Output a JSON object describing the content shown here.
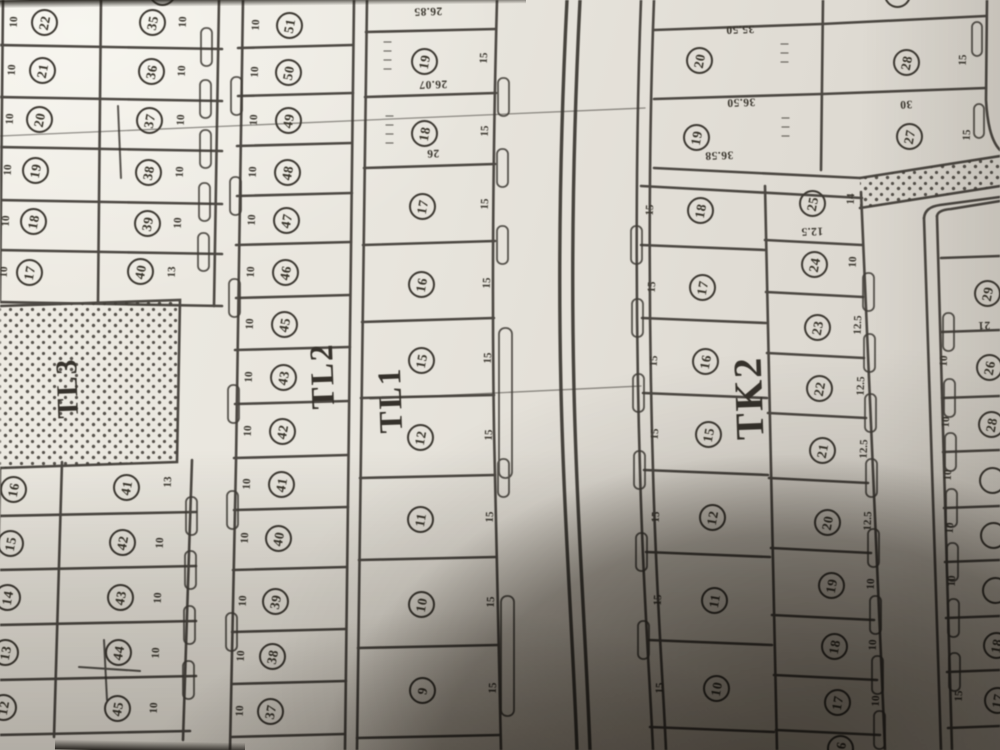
{
  "colors": {
    "paper": "#e7e4dc",
    "ink": "#3a362f",
    "shadow": "#2a251d",
    "line": "#3d3933"
  },
  "blocks": [
    {
      "label": "TL3",
      "x": 68,
      "y": 388,
      "size": 30
    },
    {
      "label": "TL2",
      "x": 323,
      "y": 376,
      "size": 33
    },
    {
      "label": "TL1",
      "x": 391,
      "y": 400,
      "size": 33
    },
    {
      "label": "TK2",
      "x": 749,
      "y": 398,
      "size": 40
    }
  ],
  "plot_groups": [
    {
      "name": "left-column-upper",
      "plots": [
        {
          "n": "22",
          "x": 44,
          "y": 22,
          "edge": "10",
          "ex": 14,
          "ey": 24
        },
        {
          "n": "21",
          "x": 42,
          "y": 70,
          "edge": "10",
          "ex": 12,
          "ey": 72
        },
        {
          "n": "20",
          "x": 39,
          "y": 119,
          "edge": "10",
          "ex": 10,
          "ey": 121
        },
        {
          "n": "19",
          "x": 35,
          "y": 170,
          "edge": "10",
          "ex": 8,
          "ey": 172
        },
        {
          "n": "18",
          "x": 33,
          "y": 221,
          "edge": "10",
          "ex": 6,
          "ey": 223
        },
        {
          "n": "17",
          "x": 29,
          "y": 272,
          "edge": "10",
          "ex": 4,
          "ey": 274
        }
      ]
    },
    {
      "name": "left-column-lower",
      "plots": [
        {
          "n": "16",
          "x": 13,
          "y": 489
        },
        {
          "n": "15",
          "x": 10,
          "y": 543
        },
        {
          "n": "14",
          "x": 7,
          "y": 597
        },
        {
          "n": "13",
          "x": 5,
          "y": 652
        },
        {
          "n": "12",
          "x": 3,
          "y": 707
        }
      ]
    },
    {
      "name": "second-column-upper",
      "plots": [
        {
          "n": "35",
          "x": 152,
          "y": 22,
          "edge": "10",
          "ex": 183,
          "ey": 24
        },
        {
          "n": "36",
          "x": 151,
          "y": 71,
          "edge": "10",
          "ex": 182,
          "ey": 73
        },
        {
          "n": "37",
          "x": 149,
          "y": 120,
          "edge": "10",
          "ex": 181,
          "ey": 122
        },
        {
          "n": "38",
          "x": 148,
          "y": 172,
          "edge": "10",
          "ex": 180,
          "ey": 174
        },
        {
          "n": "39",
          "x": 147,
          "y": 223,
          "edge": "10",
          "ex": 178,
          "ey": 225
        },
        {
          "n": "40",
          "x": 140,
          "y": 271,
          "edge": "13",
          "ex": 172,
          "ey": 274
        }
      ]
    },
    {
      "name": "second-column-lower",
      "plots": [
        {
          "n": "41",
          "x": 126,
          "y": 487,
          "edge": "13",
          "ex": 168,
          "ey": 484
        },
        {
          "n": "42",
          "x": 122,
          "y": 542,
          "edge": "10",
          "ex": 160,
          "ey": 545
        },
        {
          "n": "43",
          "x": 120,
          "y": 597,
          "edge": "10",
          "ex": 158,
          "ey": 600
        },
        {
          "n": "44",
          "x": 118,
          "y": 652,
          "edge": "10",
          "ex": 156,
          "ey": 655
        },
        {
          "n": "45",
          "x": 117,
          "y": 708,
          "edge": "10",
          "ex": 154,
          "ey": 710
        }
      ]
    },
    {
      "name": "tl2-column",
      "plots": [
        {
          "n": "51",
          "x": 289,
          "y": 25,
          "edge": "10",
          "ex": 256,
          "ey": 27
        },
        {
          "n": "50",
          "x": 288,
          "y": 72,
          "edge": "10",
          "ex": 255,
          "ey": 74
        },
        {
          "n": "49",
          "x": 288,
          "y": 120,
          "edge": "10",
          "ex": 254,
          "ey": 122
        },
        {
          "n": "48",
          "x": 287,
          "y": 172,
          "edge": "10",
          "ex": 253,
          "ey": 174
        },
        {
          "n": "47",
          "x": 286,
          "y": 220,
          "edge": "10",
          "ex": 252,
          "ey": 222
        },
        {
          "n": "46",
          "x": 285,
          "y": 272,
          "edge": "10",
          "ex": 251,
          "ey": 274
        },
        {
          "n": "45",
          "x": 284,
          "y": 324,
          "edge": "10",
          "ex": 250,
          "ey": 326
        },
        {
          "n": "43",
          "x": 283,
          "y": 377,
          "edge": "10",
          "ex": 249,
          "ey": 379
        },
        {
          "n": "42",
          "x": 282,
          "y": 431,
          "edge": "10",
          "ex": 248,
          "ey": 433
        },
        {
          "n": "41",
          "x": 281,
          "y": 484,
          "edge": "10",
          "ex": 247,
          "ey": 486
        },
        {
          "n": "40",
          "x": 278,
          "y": 538,
          "edge": "10",
          "ex": 245,
          "ey": 540
        },
        {
          "n": "39",
          "x": 275,
          "y": 601,
          "edge": "10",
          "ex": 243,
          "ey": 603
        },
        {
          "n": "38",
          "x": 272,
          "y": 656,
          "edge": "10",
          "ex": 241,
          "ey": 658
        },
        {
          "n": "37",
          "x": 270,
          "y": 711,
          "edge": "10",
          "ex": 240,
          "ey": 713
        }
      ]
    },
    {
      "name": "tl1-column",
      "plots": [
        {
          "n": "19",
          "x": 424,
          "y": 61,
          "edge": "15",
          "ex": 484,
          "ey": 60
        },
        {
          "n": "18",
          "x": 424,
          "y": 133,
          "edge": "15",
          "ex": 485,
          "ey": 133
        },
        {
          "n": "17",
          "x": 422,
          "y": 206,
          "edge": "15",
          "ex": 485,
          "ey": 206
        },
        {
          "n": "16",
          "x": 421,
          "y": 284,
          "edge": "15",
          "ex": 487,
          "ey": 285
        },
        {
          "n": "15",
          "x": 421,
          "y": 360,
          "edge": "15",
          "ex": 488,
          "ey": 360
        },
        {
          "n": "12",
          "x": 420,
          "y": 437,
          "edge": "15",
          "ex": 489,
          "ey": 437
        },
        {
          "n": "11",
          "x": 420,
          "y": 519,
          "edge": "15",
          "ex": 490,
          "ey": 519
        },
        {
          "n": "10",
          "x": 421,
          "y": 604,
          "edge": "15",
          "ex": 491,
          "ey": 604
        },
        {
          "n": "9",
          "x": 422,
          "y": 690,
          "edge": "15",
          "ex": 493,
          "ey": 690
        }
      ]
    },
    {
      "name": "tk1-left",
      "plots": [
        {
          "n": "20",
          "x": 699,
          "y": 60
        },
        {
          "n": "19",
          "x": 696,
          "y": 137
        }
      ]
    },
    {
      "name": "tk1-right",
      "plots": [
        {
          "n": "28",
          "x": 906,
          "y": 62,
          "edge": "15",
          "ex": 963,
          "ey": 62
        },
        {
          "n": "27",
          "x": 909,
          "y": 136,
          "edge": "15",
          "ex": 967,
          "ey": 137
        }
      ]
    },
    {
      "name": "tk2-left",
      "plots": [
        {
          "n": "18",
          "x": 700,
          "y": 210,
          "edge": "15",
          "ex": 650,
          "ey": 212
        },
        {
          "n": "17",
          "x": 702,
          "y": 287,
          "edge": "15",
          "ex": 652,
          "ey": 289
        },
        {
          "n": "16",
          "x": 705,
          "y": 361,
          "edge": "15",
          "ex": 654,
          "ey": 363
        },
        {
          "n": "15",
          "x": 708,
          "y": 434,
          "edge": "15",
          "ex": 655,
          "ey": 436
        },
        {
          "n": "12",
          "x": 712,
          "y": 517,
          "edge": "15",
          "ex": 656,
          "ey": 519
        },
        {
          "n": "11",
          "x": 714,
          "y": 600,
          "edge": "15",
          "ex": 658,
          "ey": 602
        },
        {
          "n": "10",
          "x": 716,
          "y": 688,
          "edge": "15",
          "ex": 660,
          "ey": 690
        }
      ]
    },
    {
      "name": "tk2-right",
      "plots": [
        {
          "n": "25",
          "x": 812,
          "y": 203,
          "edge": "14",
          "ex": 851,
          "ey": 201
        },
        {
          "n": "24",
          "x": 814,
          "y": 264,
          "edge": "10",
          "ex": 853,
          "ey": 264
        },
        {
          "n": "23",
          "x": 817,
          "y": 327,
          "edge": "12.5",
          "ex": 858,
          "ey": 327
        },
        {
          "n": "22",
          "x": 819,
          "y": 388,
          "edge": "12.5",
          "ex": 861,
          "ey": 388
        },
        {
          "n": "21",
          "x": 822,
          "y": 450,
          "edge": "12.5",
          "ex": 864,
          "ey": 451
        },
        {
          "n": "20",
          "x": 827,
          "y": 522,
          "edge": "12.5",
          "ex": 868,
          "ey": 523
        },
        {
          "n": "19",
          "x": 831,
          "y": 585,
          "edge": "10",
          "ex": 871,
          "ey": 586
        },
        {
          "n": "18",
          "x": 834,
          "y": 646,
          "edge": "10",
          "ex": 873,
          "ey": 647
        },
        {
          "n": "17",
          "x": 837,
          "y": 702,
          "edge": "10",
          "ex": 876,
          "ey": 703
        },
        {
          "n": "16",
          "x": 840,
          "y": 748
        }
      ]
    },
    {
      "name": "far-right-column",
      "plots": [
        {
          "n": "29",
          "x": 987,
          "y": 293
        },
        {
          "n": "26",
          "x": 989,
          "y": 367,
          "edge": "10",
          "ex": 944,
          "ey": 363
        },
        {
          "n": "28",
          "x": 991,
          "y": 424,
          "edge": "10",
          "ex": 946,
          "ey": 424
        },
        {
          "n": "",
          "x": 992,
          "y": 480,
          "edge": "10",
          "ex": 948,
          "ey": 477
        },
        {
          "n": "",
          "x": 993,
          "y": 535,
          "edge": "10",
          "ex": 950,
          "ey": 530
        },
        {
          "n": "",
          "x": 995,
          "y": 590,
          "edge": "10",
          "ex": 952,
          "ey": 583
        },
        {
          "n": "18",
          "x": 996,
          "y": 645
        },
        {
          "n": "17",
          "x": 997,
          "y": 700,
          "edge": "15",
          "ex": 959,
          "ey": 698
        }
      ]
    },
    {
      "name": "edge-partials",
      "plots": [
        {
          "n": "",
          "x": 162,
          "y": -8
        },
        {
          "n": "",
          "x": 897,
          "y": -6
        }
      ]
    }
  ],
  "measurements": [
    {
      "t": "26.85",
      "x": 428,
      "y": 13
    },
    {
      "t": "26.07",
      "x": 433,
      "y": 86
    },
    {
      "t": "26",
      "x": 433,
      "y": 155
    },
    {
      "t": "35.50",
      "x": 740,
      "y": 31
    },
    {
      "t": "36.50",
      "x": 741,
      "y": 104
    },
    {
      "t": "36.58",
      "x": 719,
      "y": 157
    },
    {
      "t": "30",
      "x": 906,
      "y": 106
    },
    {
      "t": "12.5",
      "x": 812,
      "y": 233
    },
    {
      "t": "21",
      "x": 984,
      "y": 327
    }
  ]
}
